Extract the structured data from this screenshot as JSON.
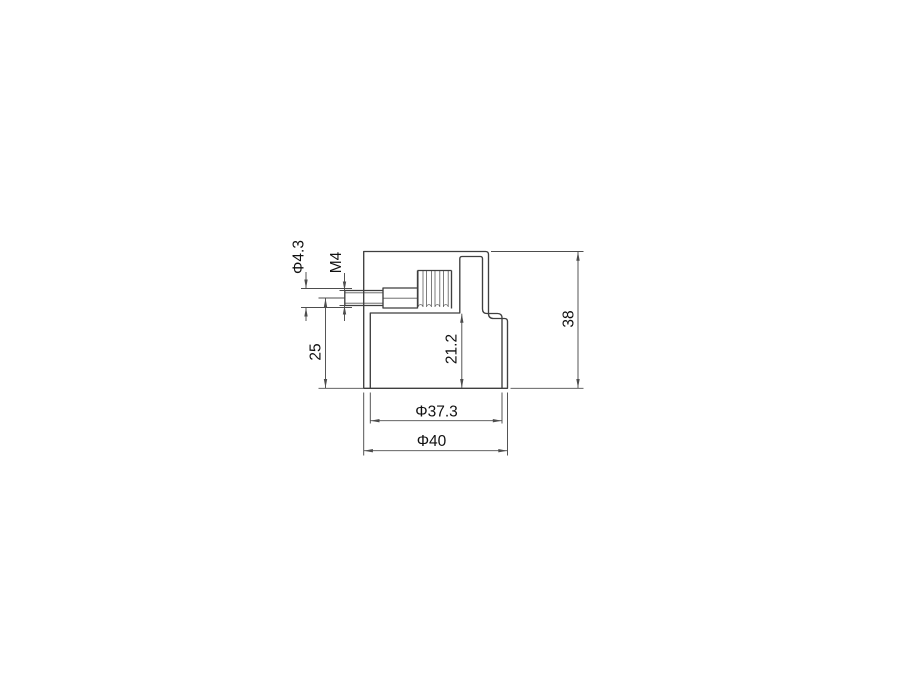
{
  "drawing": {
    "kind": "technical-dimension-drawing",
    "colors": {
      "background": "#ffffff",
      "outline": "#3f3f3f",
      "dimension": "#4d4d4d",
      "text": "#111111"
    },
    "dimensions": {
      "hole_diameter": {
        "label": "Φ4.3",
        "orientation": "vertical"
      },
      "thread": {
        "label": "M4",
        "orientation": "vertical"
      },
      "axis_to_base": {
        "label": "25",
        "orientation": "vertical"
      },
      "inner_depth": {
        "label": "21.2",
        "orientation": "vertical"
      },
      "overall_height": {
        "label": "38",
        "orientation": "vertical"
      },
      "inner_diameter": {
        "label": "Φ37.3",
        "orientation": "horizontal"
      },
      "outer_diameter": {
        "label": "Φ40",
        "orientation": "horizontal"
      }
    }
  }
}
